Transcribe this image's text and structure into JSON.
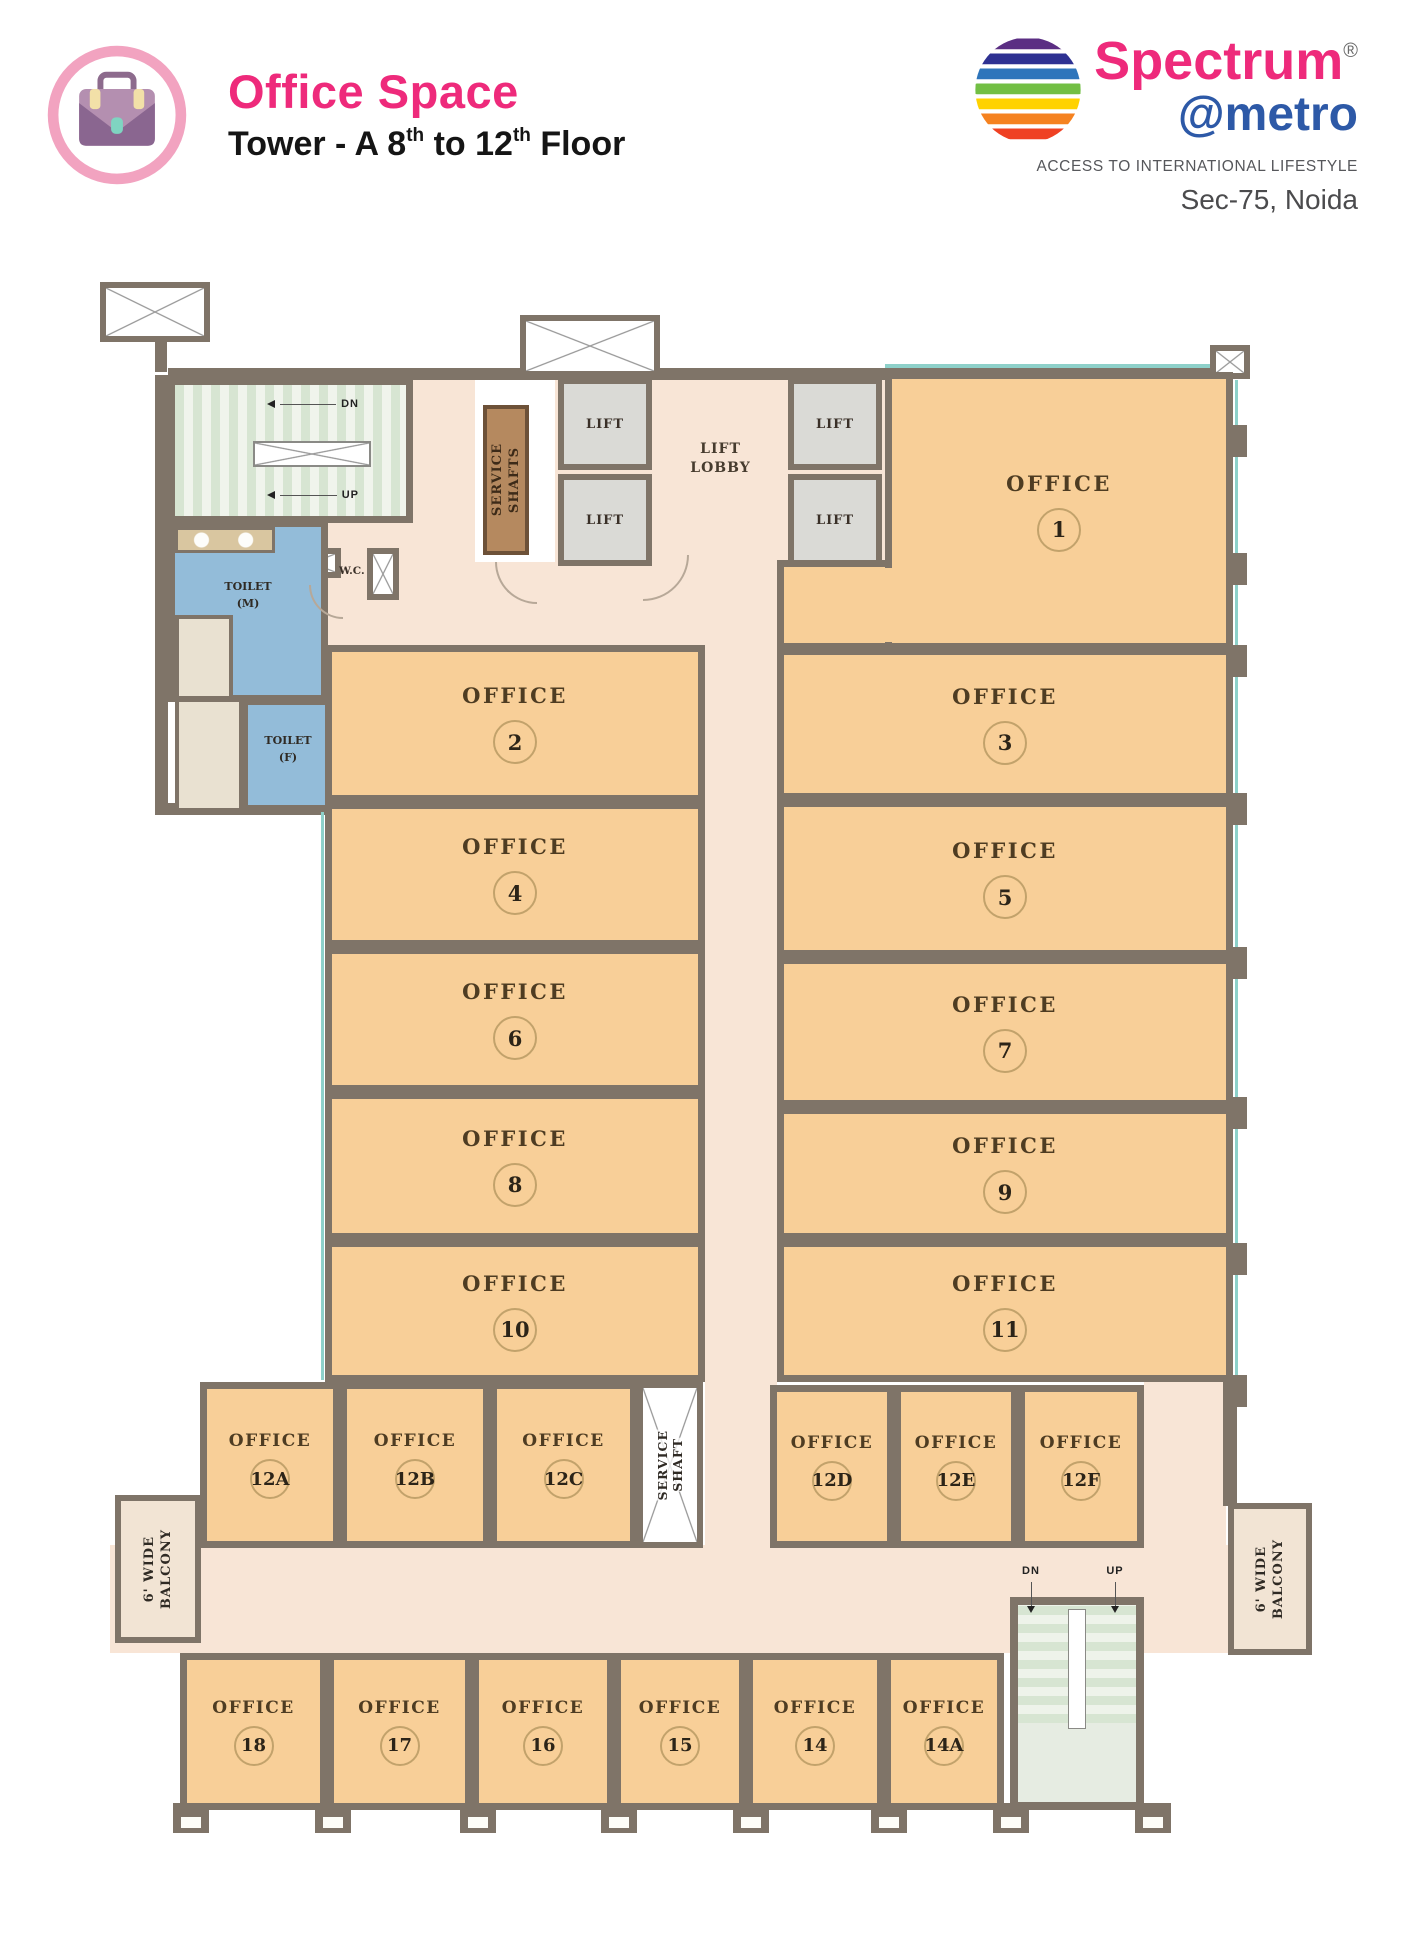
{
  "header": {
    "title": "Office Space",
    "subtitle": {
      "p0": "Tower - A 8",
      "s0": "th",
      "p1": " to 12",
      "s1": "th",
      "p2": " Floor"
    },
    "accent_color": "#ee2a7b"
  },
  "logo": {
    "brand": "Spectrum",
    "registered": "®",
    "sub_brand": "@metro",
    "tagline": "ACCESS TO INTERNATIONAL LIFESTYLE",
    "location": "Sec-75, Noida",
    "brand_color": "#ee2a7b",
    "sub_brand_color": "#2d59a7",
    "globe_colors": [
      "#5b2e83",
      "#2e3192",
      "#2e75bb",
      "#72bf44",
      "#ffd200",
      "#f58220",
      "#ef4123"
    ]
  },
  "plan": {
    "labels": {
      "office": "OFFICE",
      "lift": "LIFT",
      "lobby1": "LIFT",
      "lobby2": "LOBBY",
      "service1": "SERVICE",
      "shafts2": "SHAFTS",
      "shaft2": "SHAFT",
      "toilet_m1": "TOILET",
      "toilet_m2": "(M)",
      "toilet_f1": "TOILET",
      "toilet_f2": "(F)",
      "wc": "W.C.",
      "dn": "DN",
      "up": "UP",
      "balcony1": "6' WIDE",
      "balcony2": "BALCONY"
    },
    "colors": {
      "wall": "#7f7468",
      "office_fill": "#f8cf98",
      "corridor_fill": "#f8e5d6",
      "toilet_fill": "#93bcd9",
      "lift_fill": "#dadad6",
      "window_band": "#8ed1ca"
    },
    "offices": [
      {
        "num": "1",
        "x": 790,
        "y": 117,
        "w": 348,
        "h": 278,
        "size": "lg",
        "ext": {
          "x": 682,
          "y": 305,
          "w": 116,
          "h": 90
        },
        "patch": {
          "x": 785,
          "y": 313,
          "w": 15,
          "h": 74
        }
      },
      {
        "num": "2",
        "x": 230,
        "y": 390,
        "w": 380,
        "h": 157,
        "size": "lg"
      },
      {
        "num": "3",
        "x": 682,
        "y": 393,
        "w": 456,
        "h": 152,
        "size": "lg"
      },
      {
        "num": "4",
        "x": 230,
        "y": 547,
        "w": 380,
        "h": 145,
        "size": "lg"
      },
      {
        "num": "5",
        "x": 682,
        "y": 545,
        "w": 456,
        "h": 157,
        "size": "lg"
      },
      {
        "num": "6",
        "x": 230,
        "y": 692,
        "w": 380,
        "h": 145,
        "size": "lg"
      },
      {
        "num": "7",
        "x": 682,
        "y": 702,
        "w": 456,
        "h": 150,
        "size": "lg"
      },
      {
        "num": "8",
        "x": 230,
        "y": 837,
        "w": 380,
        "h": 148,
        "size": "lg"
      },
      {
        "num": "9",
        "x": 682,
        "y": 852,
        "w": 456,
        "h": 133,
        "size": "lg"
      },
      {
        "num": "10",
        "x": 230,
        "y": 985,
        "w": 380,
        "h": 142,
        "size": "lg"
      },
      {
        "num": "11",
        "x": 682,
        "y": 985,
        "w": 456,
        "h": 142,
        "size": "lg"
      },
      {
        "num": "12A",
        "x": 105,
        "y": 1127,
        "w": 140,
        "h": 166,
        "size": "sm"
      },
      {
        "num": "12B",
        "x": 245,
        "y": 1127,
        "w": 150,
        "h": 166,
        "size": "sm"
      },
      {
        "num": "12C",
        "x": 395,
        "y": 1127,
        "w": 147,
        "h": 166,
        "size": "sm"
      },
      {
        "num": "12D",
        "x": 675,
        "y": 1130,
        "w": 124,
        "h": 163,
        "size": "sm"
      },
      {
        "num": "12E",
        "x": 799,
        "y": 1130,
        "w": 124,
        "h": 163,
        "size": "sm"
      },
      {
        "num": "12F",
        "x": 923,
        "y": 1130,
        "w": 126,
        "h": 163,
        "size": "sm"
      },
      {
        "num": "18",
        "x": 85,
        "y": 1398,
        "w": 147,
        "h": 157,
        "size": "sm"
      },
      {
        "num": "17",
        "x": 232,
        "y": 1398,
        "w": 145,
        "h": 157,
        "size": "sm"
      },
      {
        "num": "16",
        "x": 377,
        "y": 1398,
        "w": 142,
        "h": 157,
        "size": "sm"
      },
      {
        "num": "15",
        "x": 519,
        "y": 1398,
        "w": 132,
        "h": 157,
        "size": "sm"
      },
      {
        "num": "14",
        "x": 651,
        "y": 1398,
        "w": 138,
        "h": 157,
        "size": "sm"
      },
      {
        "num": "14A",
        "x": 789,
        "y": 1398,
        "w": 120,
        "h": 157,
        "size": "sm"
      }
    ],
    "lifts": [
      {
        "x": 463,
        "y": 123,
        "w": 94,
        "h": 92
      },
      {
        "x": 463,
        "y": 219,
        "w": 94,
        "h": 92
      },
      {
        "x": 693,
        "y": 123,
        "w": 94,
        "h": 92
      },
      {
        "x": 693,
        "y": 219,
        "w": 94,
        "h": 92
      }
    ]
  }
}
